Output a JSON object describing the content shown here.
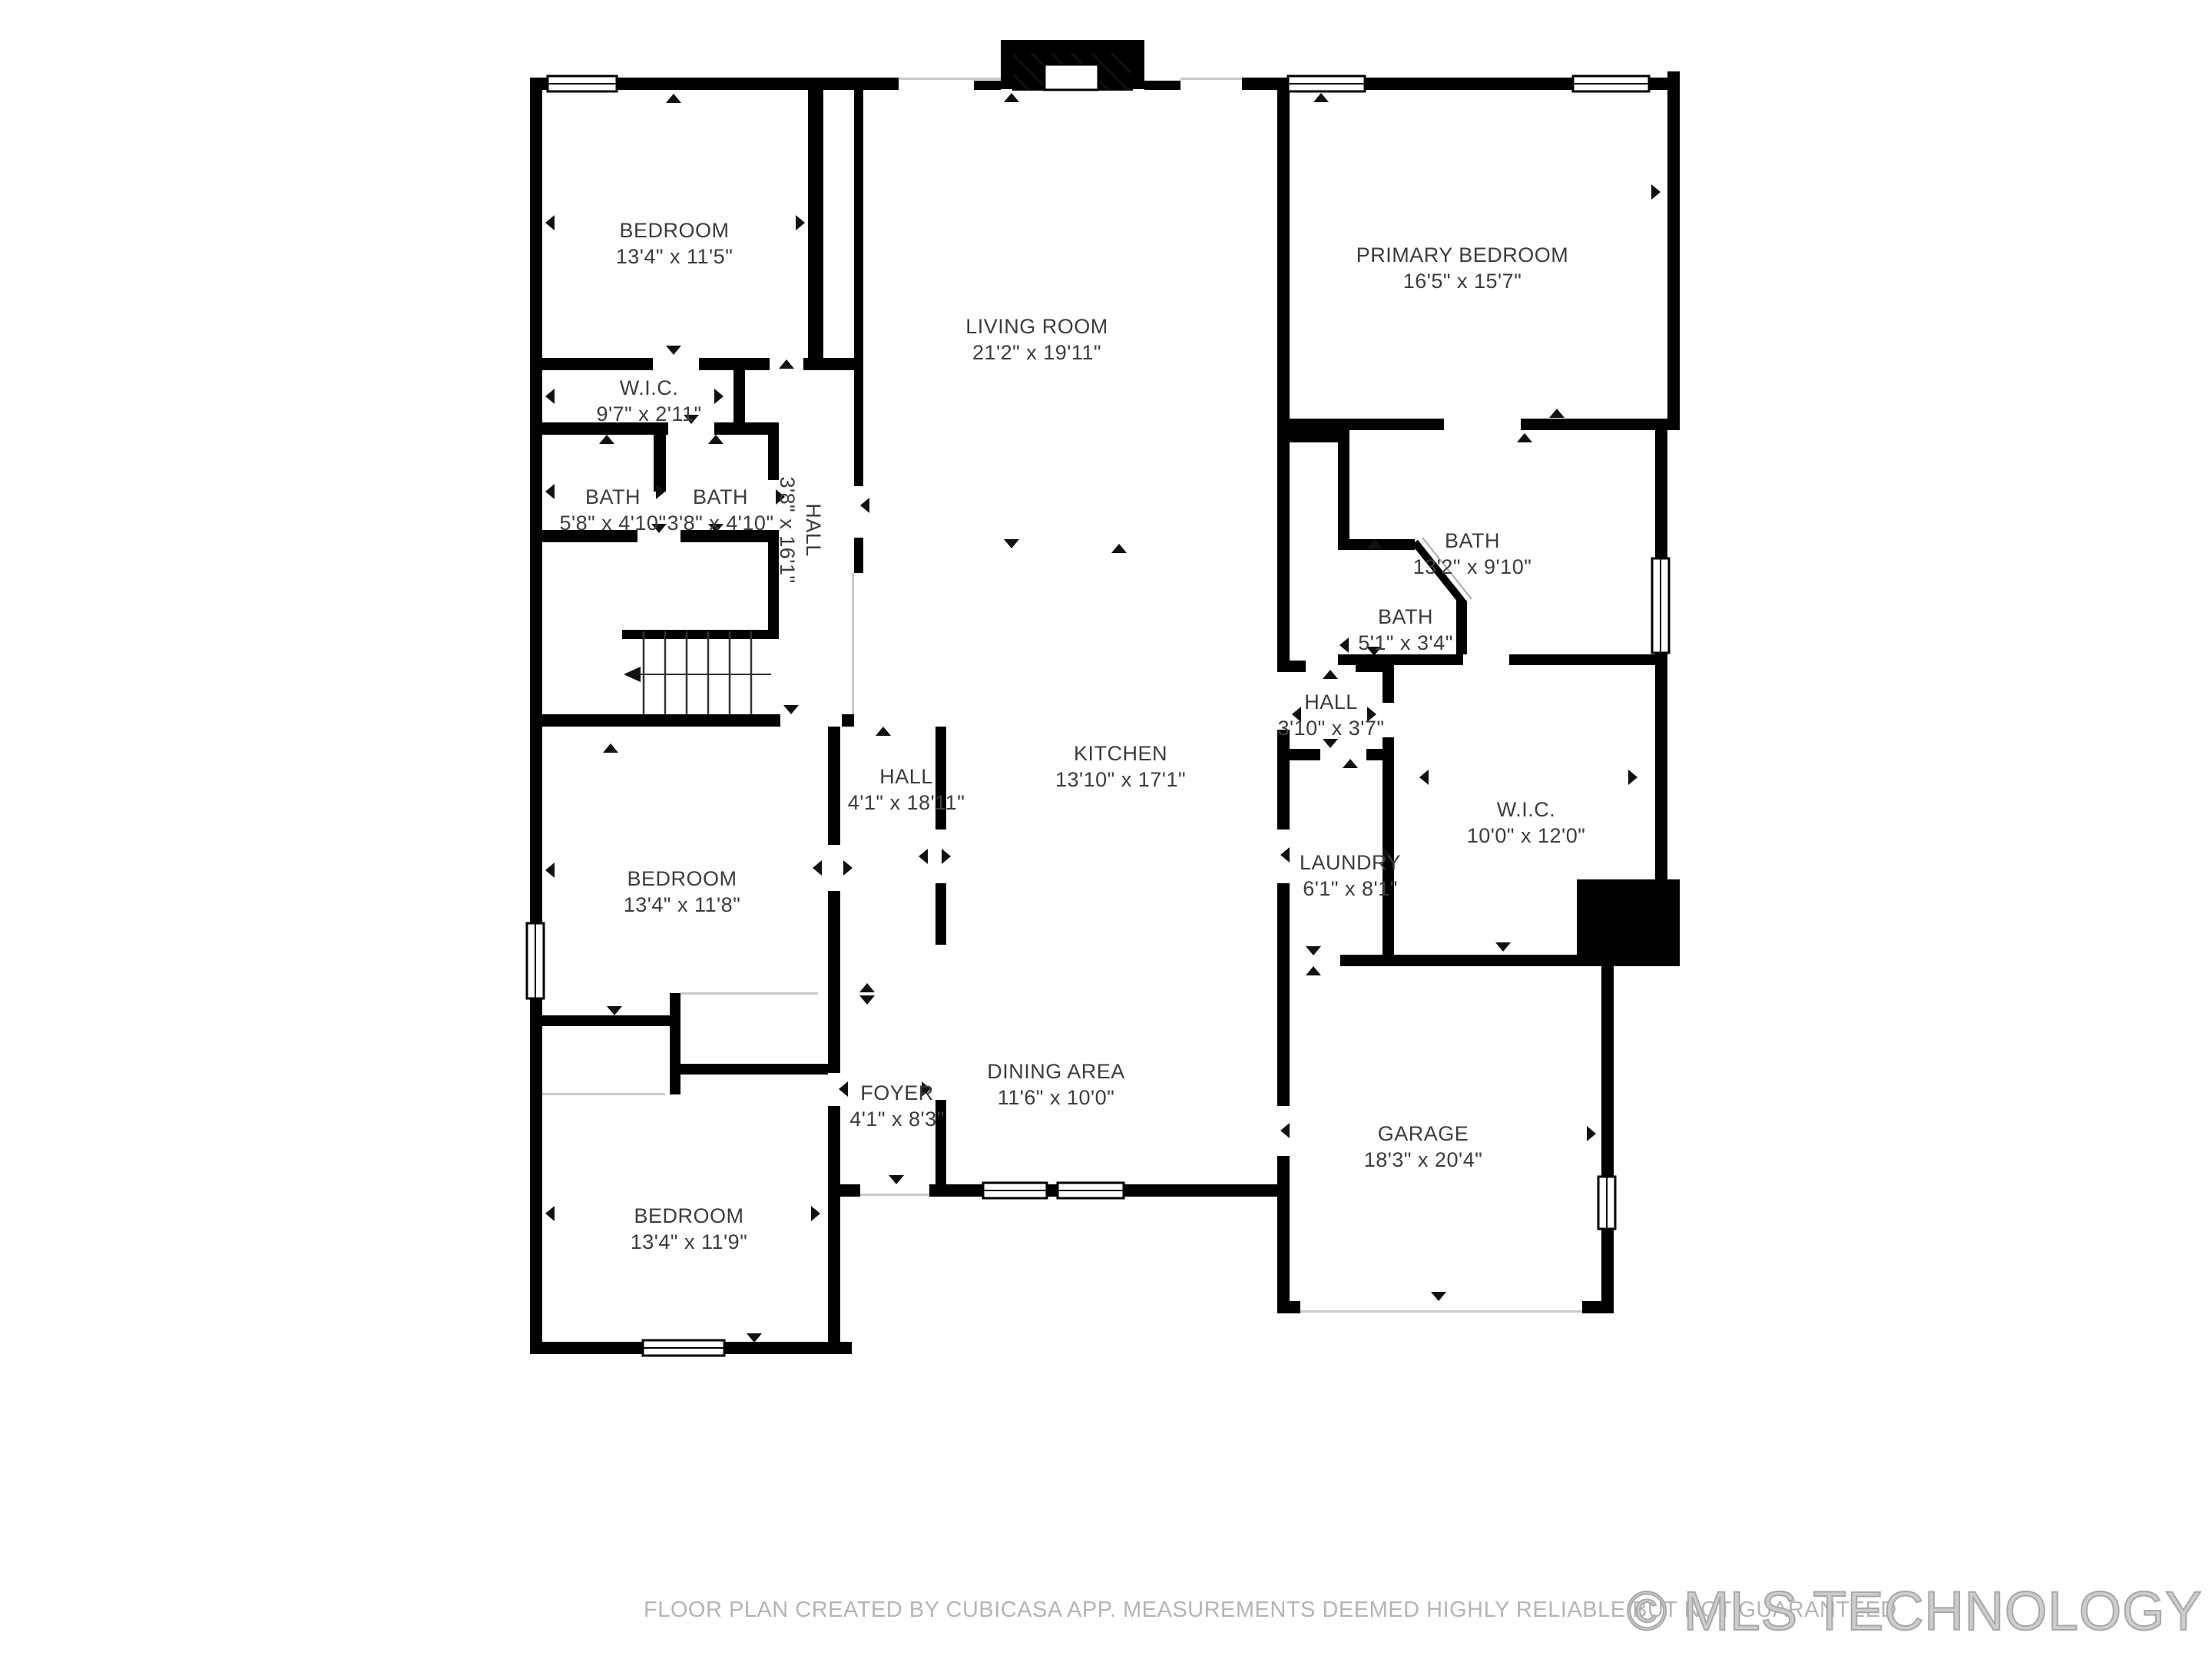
{
  "rooms": [
    {
      "id": "bedroom-1",
      "name": "BEDROOM",
      "dims": "13'4\" x 11'5\""
    },
    {
      "id": "wic-1",
      "name": "W.I.C.",
      "dims": "9'7\" x 2'11\""
    },
    {
      "id": "bath-1",
      "name": "BATH",
      "dims": "5'8\" x 4'10\""
    },
    {
      "id": "bath-2",
      "name": "BATH",
      "dims": "3'8\" x 4'10\""
    },
    {
      "id": "hall-upper",
      "name": "HALL",
      "dims": "3'8\" x 16'1\""
    },
    {
      "id": "living-room",
      "name": "LIVING ROOM",
      "dims": "21'2\" x 19'11\""
    },
    {
      "id": "primary-bedroom",
      "name": "PRIMARY BEDROOM",
      "dims": "16'5\" x 15'7\""
    },
    {
      "id": "bath-primary",
      "name": "BATH",
      "dims": "13'2\" x 9'10\""
    },
    {
      "id": "bath-small",
      "name": "BATH",
      "dims": "5'1\" x 3'4\""
    },
    {
      "id": "hall-small",
      "name": "HALL",
      "dims": "3'10\" x 3'7\""
    },
    {
      "id": "kitchen",
      "name": "KITCHEN",
      "dims": "13'10\" x 17'1\""
    },
    {
      "id": "laundry",
      "name": "LAUNDRY",
      "dims": "6'1\" x 8'1\""
    },
    {
      "id": "wic-2",
      "name": "W.I.C.",
      "dims": "10'0\" x 12'0\""
    },
    {
      "id": "hall-lower",
      "name": "HALL",
      "dims": "4'1\" x 18'11\""
    },
    {
      "id": "bedroom-2",
      "name": "BEDROOM",
      "dims": "13'4\" x 11'8\""
    },
    {
      "id": "foyer",
      "name": "FOYER",
      "dims": "4'1\" x 8'3\""
    },
    {
      "id": "dining-area",
      "name": "DINING AREA",
      "dims": "11'6\" x 10'0\""
    },
    {
      "id": "garage",
      "name": "GARAGE",
      "dims": "18'3\" x 20'4\""
    },
    {
      "id": "bedroom-3",
      "name": "BEDROOM",
      "dims": "13'4\" x 11'9\""
    }
  ],
  "footer": {
    "disclaimer": "FLOOR PLAN CREATED BY CUBICASA APP. MEASUREMENTS DEEMED HIGHLY RELIABLE BUT NOT GUARANTEED"
  },
  "watermark": {
    "text": "© MLS TECHNOLOGY INC 2026"
  }
}
